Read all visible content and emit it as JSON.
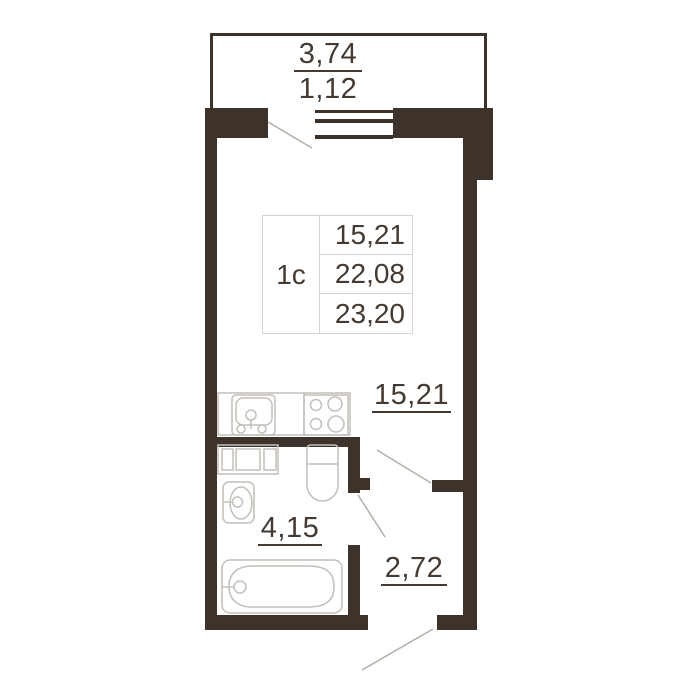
{
  "unit_table": {
    "type": "1c",
    "values": [
      "15,21",
      "22,08",
      "23,20"
    ]
  },
  "dimensions": {
    "balcony_width": "3,74",
    "balcony_depth": "1,12"
  },
  "areas": {
    "living_room": "15,21",
    "bathroom": "4,15",
    "hallway": "2,72"
  },
  "icons": {
    "kitchen_sink": "sink-icon",
    "stove": "stove-icon",
    "washing_machine": "washer-icon",
    "washbasin": "washbasin-icon",
    "toilet": "toilet-icon",
    "bathtub": "bathtub-icon",
    "window": "window-icon",
    "door_swing": "door-swing-line"
  },
  "colors": {
    "wall": "#3E332B",
    "text": "#443A32",
    "fixture_stroke": "#C4BFB9",
    "door_swing_stroke": "#B5AEA6",
    "table_border": "#D7D3CF",
    "background": "#FFFFFF"
  }
}
